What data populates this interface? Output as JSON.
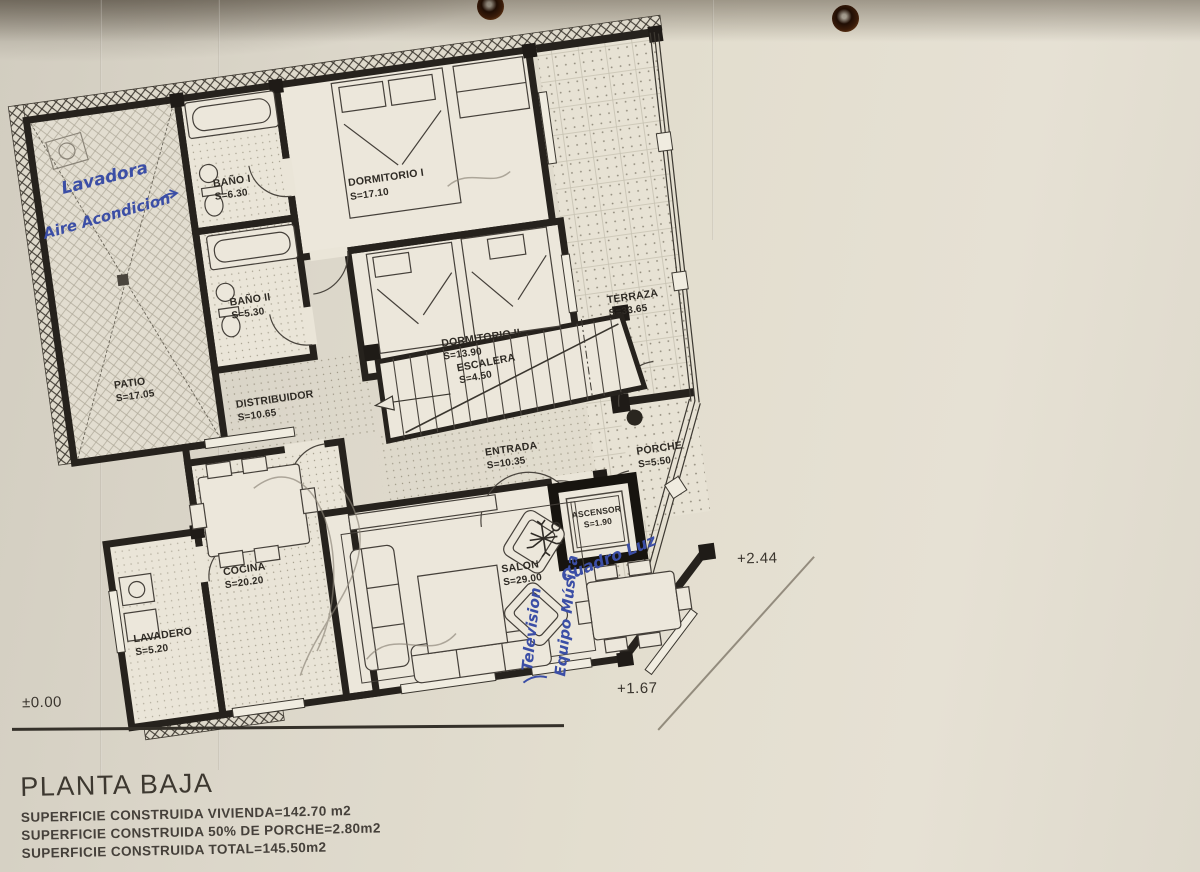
{
  "rooms": {
    "patio": {
      "name": "PATIO",
      "area": "S=17.05"
    },
    "banio1": {
      "name": "BAÑO I",
      "area": "S=6.30"
    },
    "banio2": {
      "name": "BAÑO II",
      "area": "S=5.30"
    },
    "dormitorio1": {
      "name": "DORMITORIO I",
      "area": "S=17.10"
    },
    "dormitorio2": {
      "name": "DORMITORIO II",
      "area": "S=13.90"
    },
    "distribuidor": {
      "name": "DISTRIBUIDOR",
      "area": "S=10.65"
    },
    "escalera": {
      "name": "ESCALERA",
      "area": "S=4.50"
    },
    "entrada": {
      "name": "ENTRADA",
      "area": "S=10.35"
    },
    "terraza": {
      "name": "TERRAZA",
      "area": "S=33.65"
    },
    "porche": {
      "name": "PORCHE",
      "area": "S=5.50"
    },
    "ascensor": {
      "name": "ASCENSOR",
      "area": "S=1.90"
    },
    "cocina": {
      "name": "COCINA",
      "area": "S=20.20"
    },
    "lavadero": {
      "name": "LAVADERO",
      "area": "S=5.20"
    },
    "salon": {
      "name": "SALON",
      "area": "S=29.00"
    }
  },
  "levels": {
    "ground": "±0.00",
    "porch": "+1.67",
    "terrace": "+2.44"
  },
  "handwritten": {
    "lavadora": "Lavadora",
    "aire": "Aire Acondicion",
    "television": "Television",
    "equipo_musica": "Equipo Música",
    "cuadro_luz": "Cuadro Luz"
  },
  "title_block": {
    "title": "PLANTA BAJA",
    "lines": [
      "SUPERFICIE CONSTRUIDA VIVIENDA=142.70 m2",
      "SUPERFICIE CONSTRUIDA 50% DE PORCHE=2.80m2",
      "SUPERFICIE CONSTRUIDA TOTAL=145.50m2"
    ]
  },
  "icons": {
    "plant": "✳",
    "punch_hole": "●",
    "porch_column": "●"
  },
  "colors": {
    "ink": "#2e2a24",
    "wall": "#26221d",
    "handwriting": "#3b4ea6",
    "paper": "#e3decf"
  }
}
